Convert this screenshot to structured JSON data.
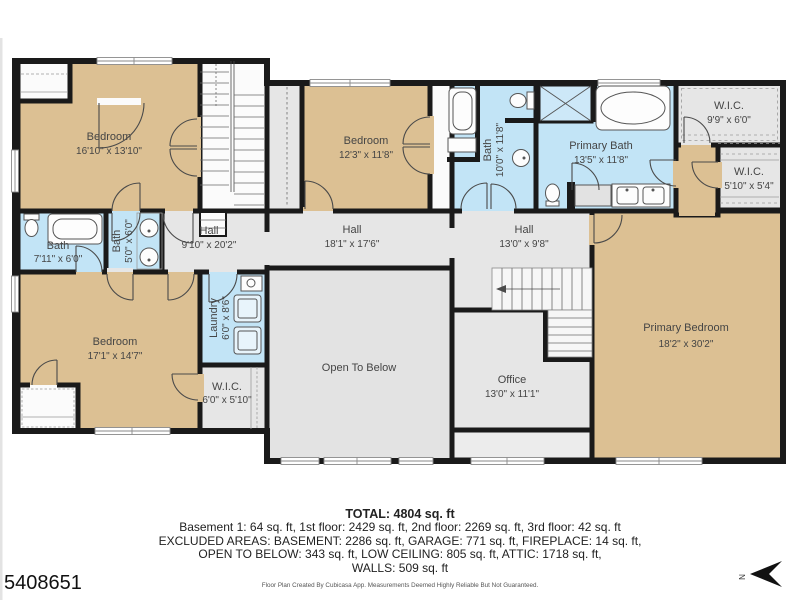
{
  "plan": {
    "rooms": {
      "bedroom_top_left": {
        "name": "Bedroom",
        "dims": "16'10\" x 13'10\""
      },
      "bedroom_middle": {
        "name": "Bedroom",
        "dims": "12'3\" x 11'8\""
      },
      "bedroom_bottom_left": {
        "name": "Bedroom",
        "dims": "17'1\" x 14'7\""
      },
      "primary_bedroom": {
        "name": "Primary Bedroom",
        "dims": "18'2\" x 30'2\""
      },
      "bath_left": {
        "name": "Bath",
        "dims": "7'11\" x 6'0\""
      },
      "bath_small": {
        "name": "Bath",
        "dims": "5'0\" x 6'0\""
      },
      "bath_middle": {
        "name": "Bath",
        "dims": "10'0\" x 11'8\""
      },
      "primary_bath": {
        "name": "Primary Bath",
        "dims": "13'5\" x 11'8\""
      },
      "hall_left": {
        "name": "Hall",
        "dims": "9'10\" x 20'2\""
      },
      "hall_middle": {
        "name": "Hall",
        "dims": "18'1\" x 17'6\""
      },
      "hall_right": {
        "name": "Hall",
        "dims": "13'0\" x 9'8\""
      },
      "laundry": {
        "name": "Laundry",
        "dims": "6'0\" x 8'6\""
      },
      "wic_bottom_left": {
        "name": "W.I.C.",
        "dims": "6'0\" x 5'10\""
      },
      "wic_top_right": {
        "name": "W.I.C.",
        "dims": "9'9\" x 6'0\""
      },
      "wic_right": {
        "name": "W.I.C.",
        "dims": "5'10\" x 5'4\""
      },
      "office": {
        "name": "Office",
        "dims": "13'0\" x 11'1\""
      },
      "open_to_below": {
        "name": "Open To Below"
      }
    },
    "compass_label": "N"
  },
  "summary": {
    "total": "TOTAL: 4804 sq. ft",
    "floors": "Basement 1: 64 sq. ft, 1st floor: 2429 sq. ft, 2nd floor: 2269 sq. ft, 3rd floor: 42 sq. ft",
    "excluded_line1": "EXCLUDED AREAS: BASEMENT: 2286 sq. ft, GARAGE: 771 sq. ft, FIREPLACE: 14 sq. ft,",
    "excluded_line2": "OPEN TO BELOW: 343 sq. ft, LOW CEILING: 805 sq. ft, ATTIC: 1718 sq. ft,",
    "walls": "WALLS: 509 sq. ft",
    "disclaimer": "Floor Plan Created By Cubicasa App. Measurements Deemed Highly Reliable But Not Guaranteed."
  },
  "listing_id": "5408651",
  "colors": {
    "room_tan": "#dcc093",
    "room_blue": "#c2e4f6",
    "room_gray": "#e6e6e6",
    "wall": "#1a1a1a"
  }
}
